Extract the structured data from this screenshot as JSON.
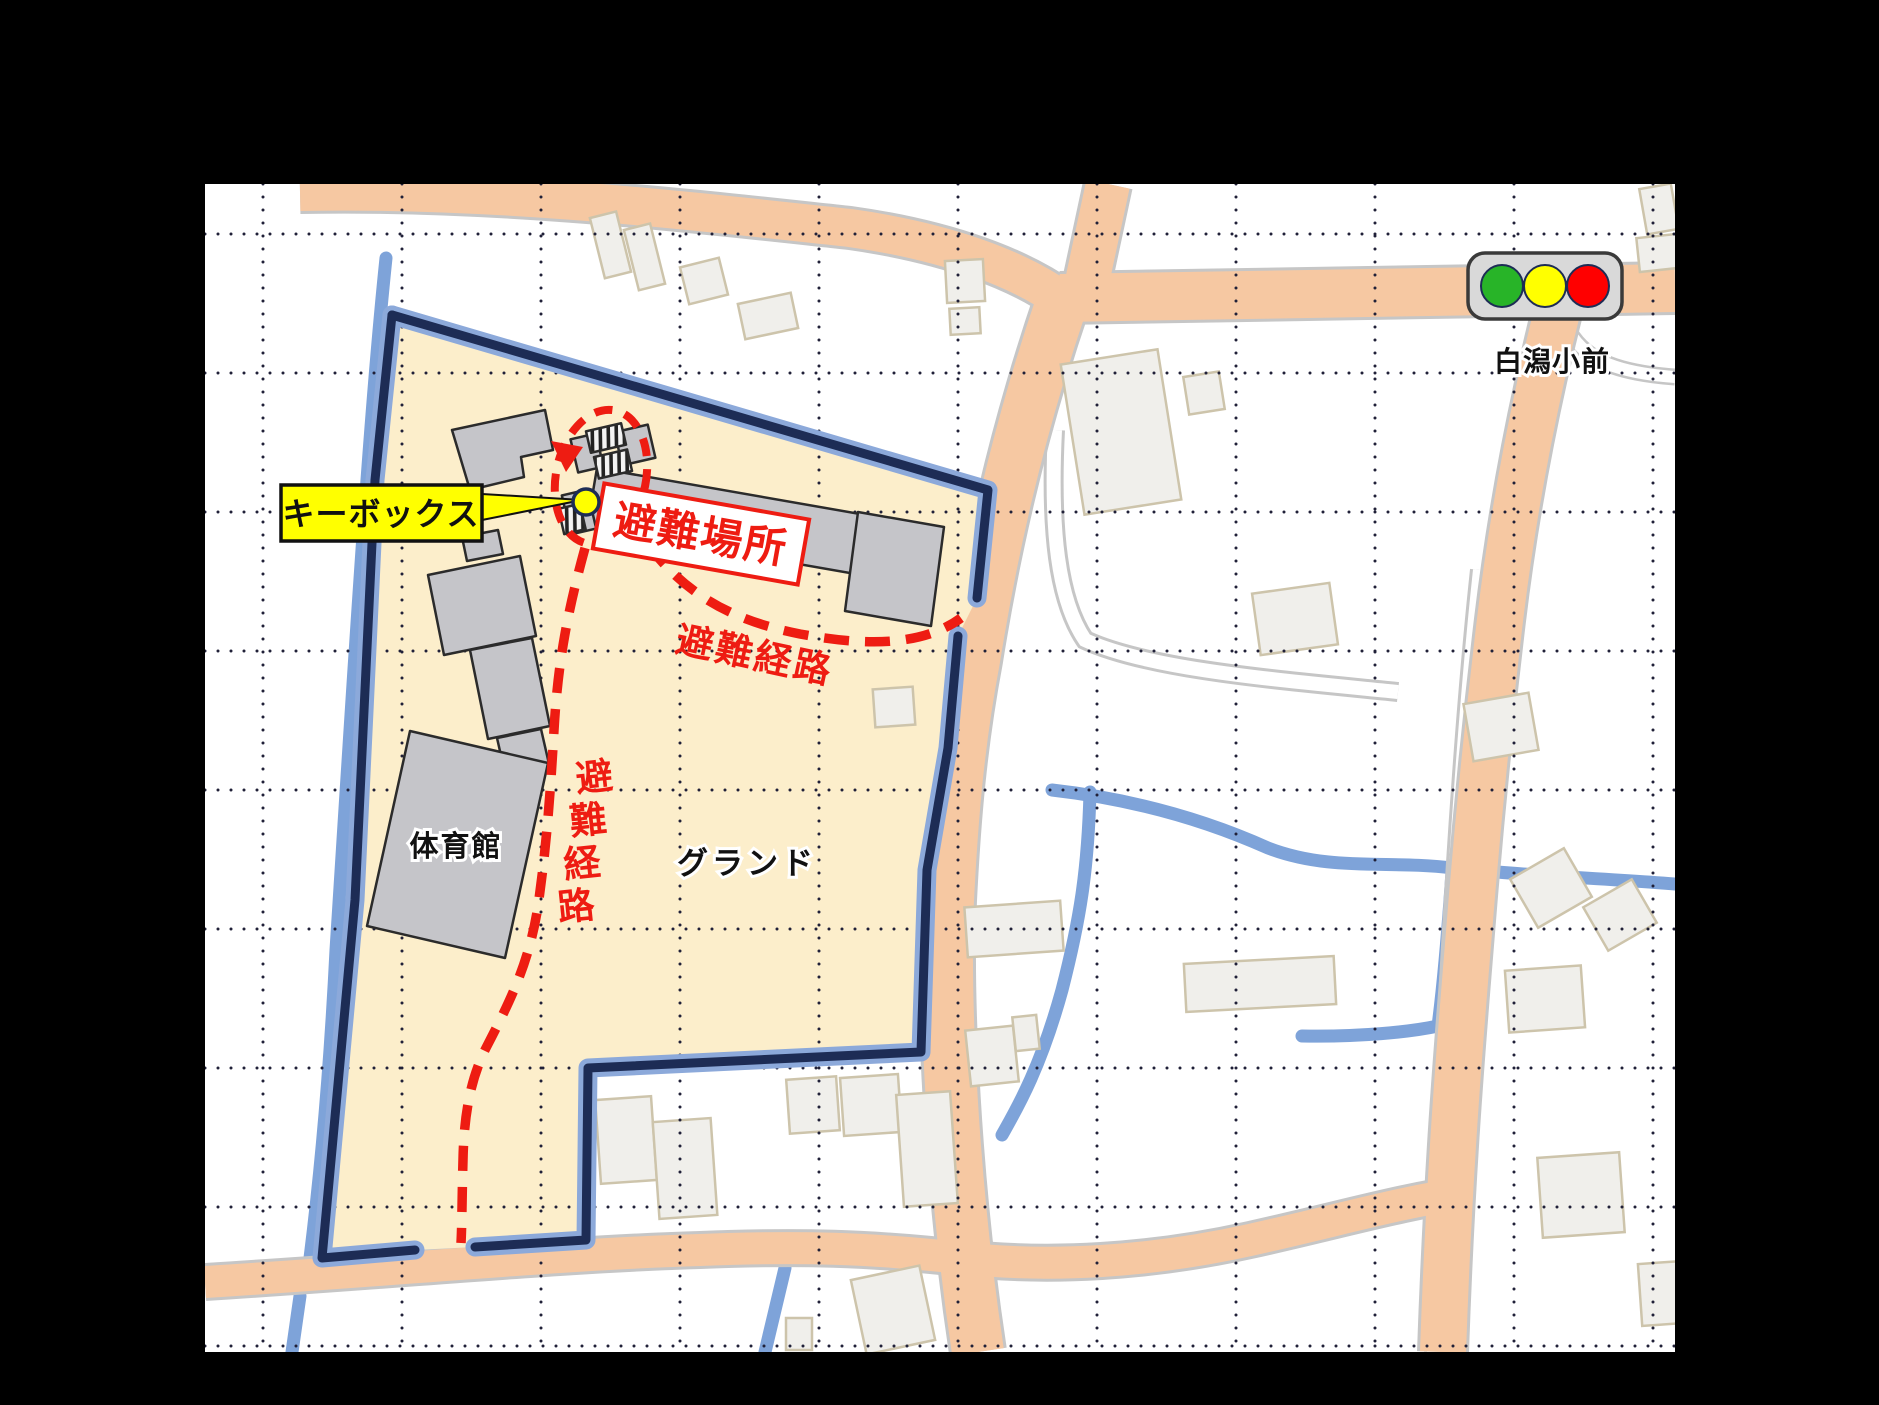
{
  "frame_color": "#000000",
  "map_bg": "#ffffff",
  "school": {
    "site_color": "#fceecb",
    "boundary_color": "#1d2c55",
    "boundary_halo_color": "#8ca9da",
    "building_color": "#c5c5c9",
    "labels": {
      "gym": "体育館",
      "ground": "グランド"
    }
  },
  "evacuation": {
    "site_label": "避難場所",
    "route_label": "避難経路",
    "route_label_vertical": [
      "避",
      "難",
      "経",
      "路"
    ],
    "keybox_label": "キーボックス",
    "route_color": "#ee1c12",
    "keybox_color": "#ffff00"
  },
  "traffic_signal": {
    "name": "白潟小前",
    "body_color": "#d9d9d9",
    "light_names": [
      "green-light",
      "yellow-light",
      "red-light"
    ],
    "light_colors": [
      "#28b428",
      "#ffff00",
      "#ff0000"
    ]
  },
  "base_map": {
    "road_color": "#f6c8a2",
    "road_casing": "#c6c6c6",
    "water_color": "#7ea3d9",
    "house_color": "#f0efeb",
    "house_outline": "#cdc4ab",
    "grid_dot_color": "#202038"
  }
}
